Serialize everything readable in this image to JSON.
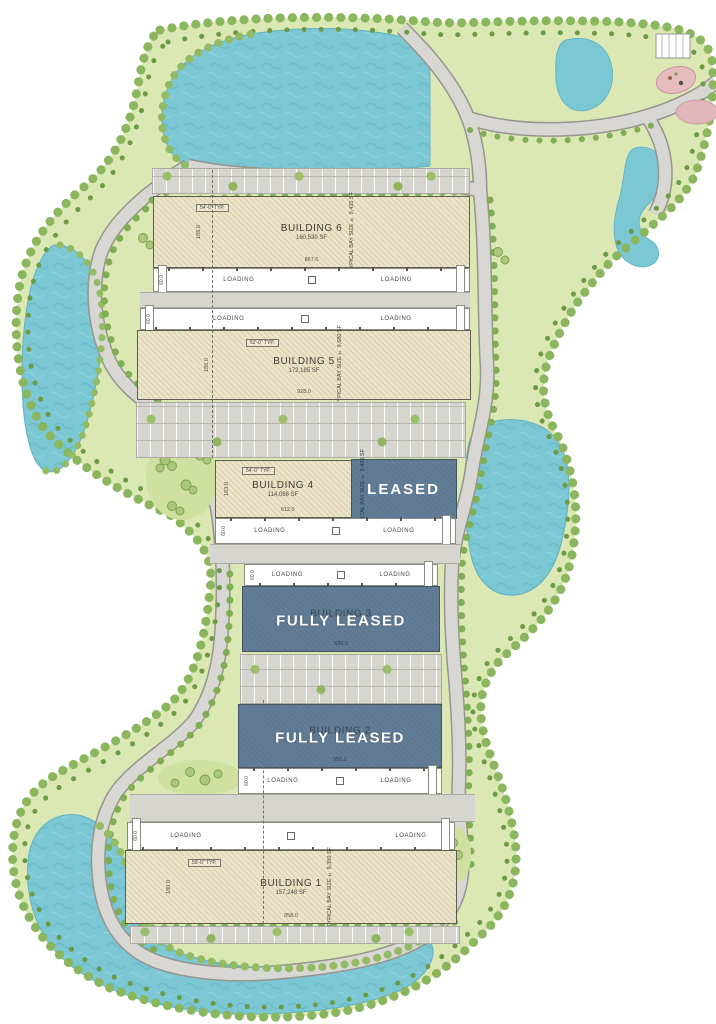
{
  "plan": {
    "loading_label": "LOADING",
    "loading_depth_dim": "60.0",
    "bay_label": "TYPICAL BAY SIZE",
    "buildings": [
      {
        "name": "BUILDING 6",
        "area": "160,530 SF",
        "bay_value": "± 9,435 SF",
        "width_dim": "867.0",
        "depth_dim": "185.0",
        "typ_dim": "54'-0\" TYP.",
        "status": ""
      },
      {
        "name": "BUILDING 5",
        "area": "172,185 SF",
        "bay_value": "± 9,680 SF",
        "width_dim": "928.0",
        "depth_dim": "185.0",
        "typ_dim": "52'-0\" TYP.",
        "status": ""
      },
      {
        "name": "BUILDING 4",
        "area": "114,088 SF",
        "bay_value": "± 9,435 SF",
        "width_dim": "612.0",
        "depth_dim": "163.0",
        "typ_dim": "54'-0\" TYP.",
        "status": "LEASED"
      },
      {
        "name": "BUILDING 3",
        "area": "",
        "bay_value": "",
        "width_dim": "536.0",
        "depth_dim": "",
        "typ_dim": "",
        "status": "FULLY LEASED"
      },
      {
        "name": "BUILDING 2",
        "area": "",
        "bay_value": "",
        "width_dim": "556.0",
        "depth_dim": "",
        "typ_dim": "",
        "status": "FULLY LEASED"
      },
      {
        "name": "BUILDING 1",
        "area": "157,248 SF",
        "bay_value": "± 9,350 SF",
        "width_dim": "858.0",
        "depth_dim": "180.0",
        "typ_dim": "50'-0\" TYP.",
        "status": ""
      }
    ],
    "colors": {
      "leased_overlay": "#5e7993",
      "pond": "#7cc7d4",
      "landscape": "#dbe8b4",
      "road": "#d8d7d3",
      "building_fill": "#ece4c9",
      "tree": "#8ab65e"
    }
  }
}
